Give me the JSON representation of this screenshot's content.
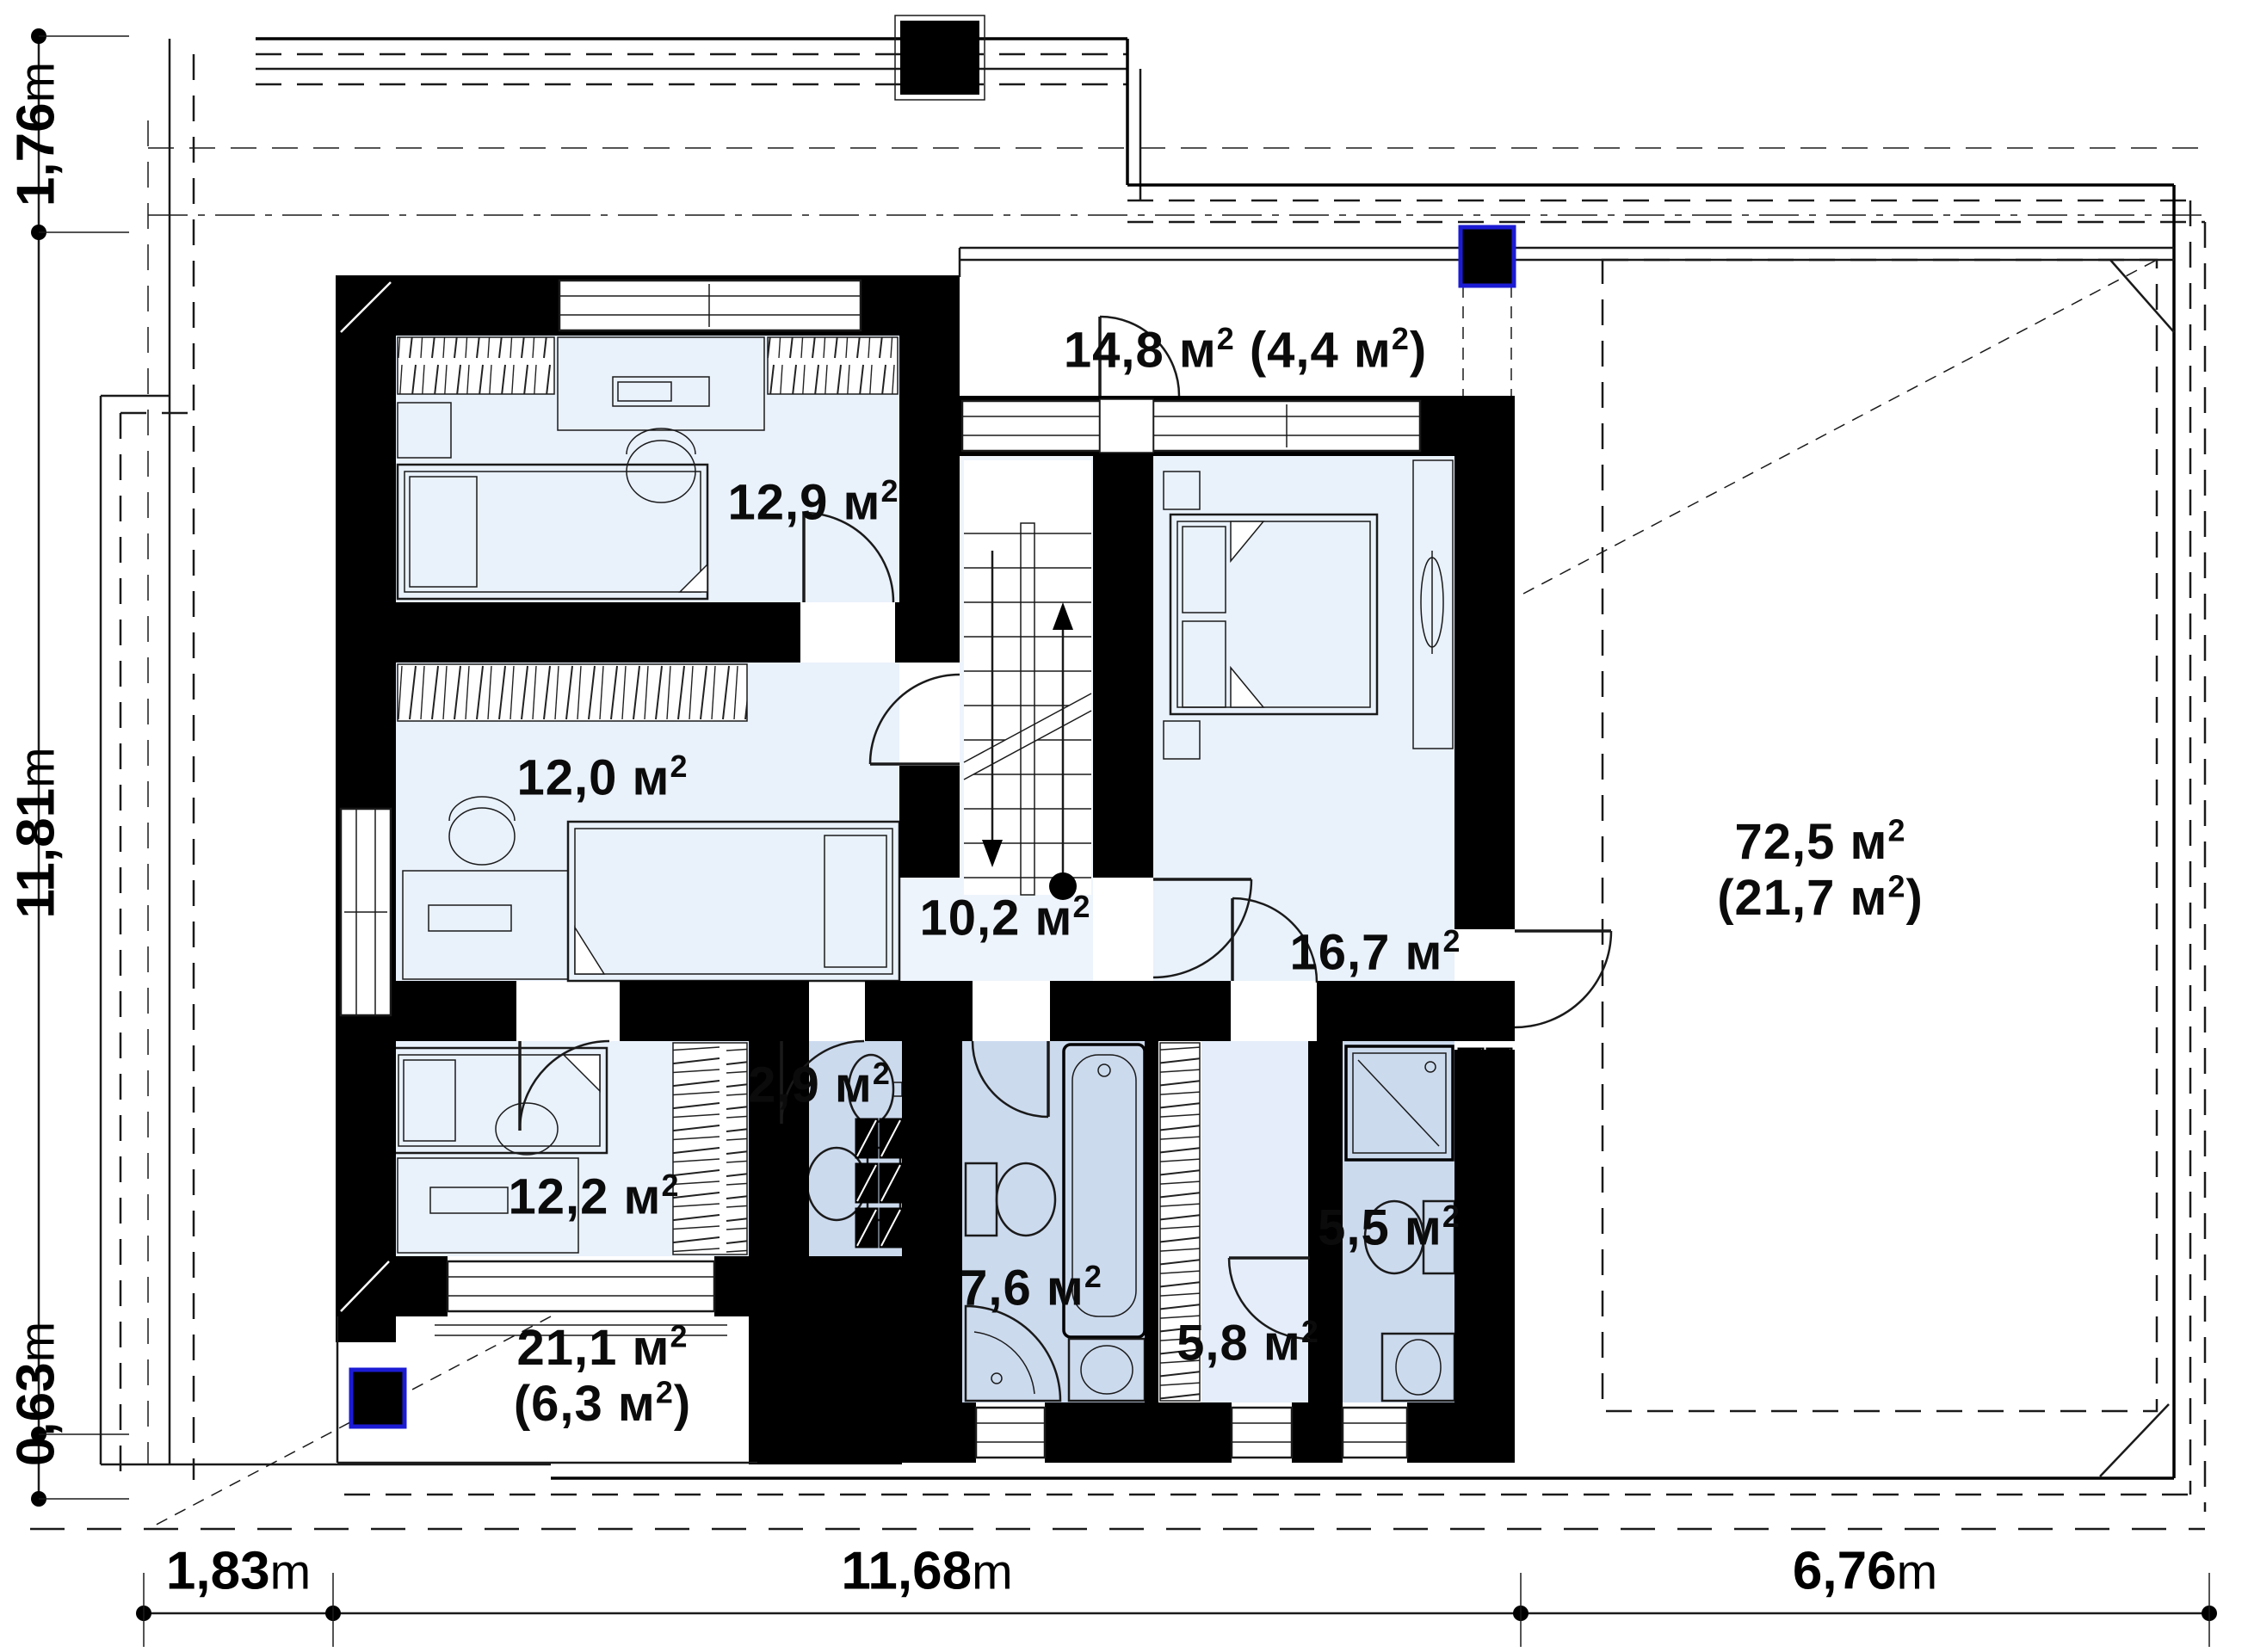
{
  "title": "Floor plan – attic level",
  "units": {
    "area_letter": "м",
    "sup_digit": "2",
    "dim_letter": "m"
  },
  "rooms": [
    {
      "id": "balcony-top",
      "num": "14,8",
      "paren": "4,4",
      "layout": "inline"
    },
    {
      "id": "bedroom-top-left",
      "num": "12,9"
    },
    {
      "id": "bedroom-mid-left",
      "num": "12,0"
    },
    {
      "id": "hall",
      "num": "10,2"
    },
    {
      "id": "master-bedroom",
      "num": "16,7"
    },
    {
      "id": "roof-terrace-right",
      "num": "72,5",
      "paren": "21,7",
      "layout": "stacked"
    },
    {
      "id": "wc",
      "num": "2,9"
    },
    {
      "id": "bedroom-bottom-left",
      "num": "12,2"
    },
    {
      "id": "bathroom",
      "num": "7,6"
    },
    {
      "id": "wardrobe",
      "num": "5,8"
    },
    {
      "id": "master-bathroom",
      "num": "5,5"
    },
    {
      "id": "terrace-bottom-left",
      "num": "21,1",
      "paren": "6,3",
      "layout": "stacked"
    }
  ],
  "dimensions": {
    "left": [
      {
        "value": "1,76"
      },
      {
        "value": "11,81"
      },
      {
        "value": "0,63"
      }
    ],
    "bottom": [
      {
        "value": "1,83"
      },
      {
        "value": "11,68"
      },
      {
        "value": "6,76"
      }
    ]
  },
  "colors": {
    "wall": "#000000",
    "chimney_accent": "#1b1bd4",
    "bedroom_floor": "#e9f1fb",
    "hall_floor": "#eef4fc",
    "bathroom_floor": "#ccdaee",
    "furniture_fill": "#c6d8f0"
  }
}
